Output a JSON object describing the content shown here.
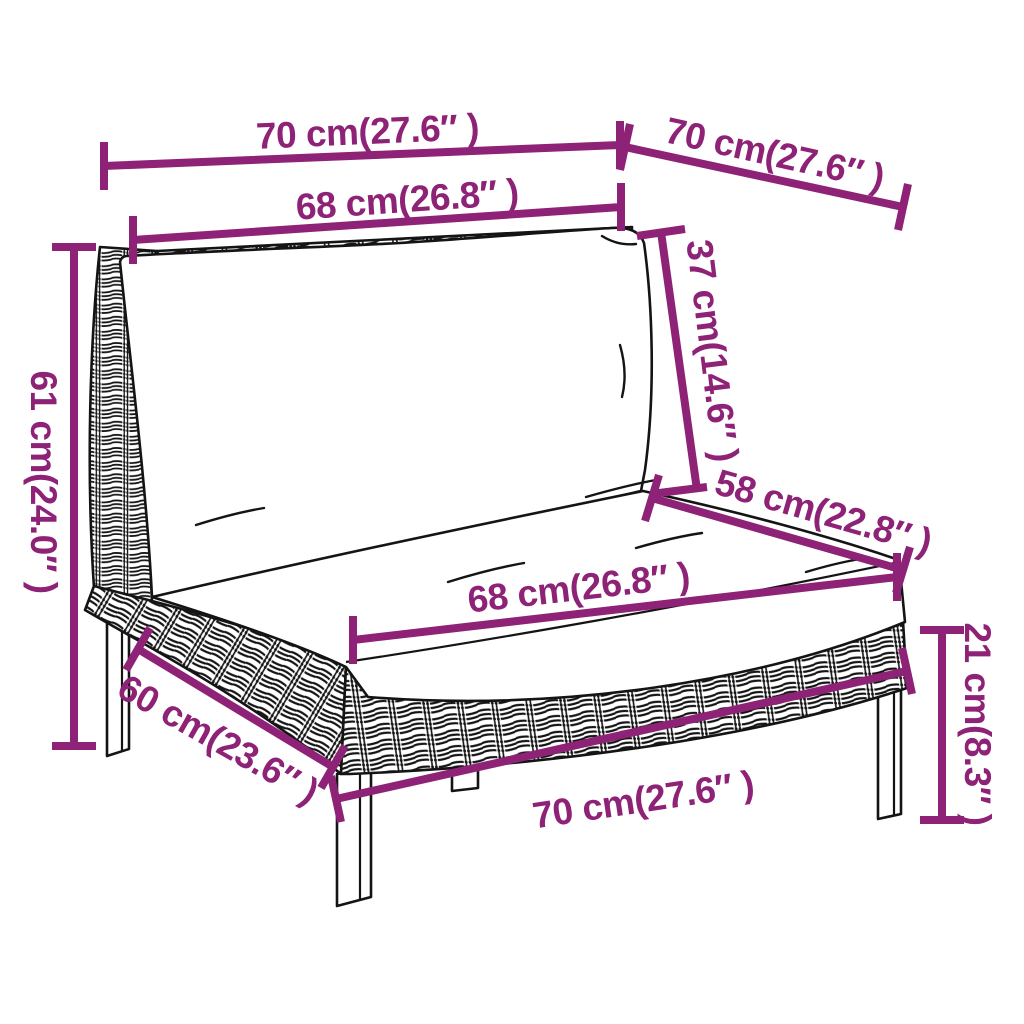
{
  "diagram": {
    "accent_color": "#8e2276",
    "outline_color": "#141414",
    "background_color": "#ffffff",
    "dimensions": {
      "top_width": "70 cm(27.6″ )",
      "top_depth": "70 cm(27.6″ )",
      "back_cushion_width": "68 cm(26.8″ )",
      "back_cushion_height": "37 cm(14.6″ )",
      "overall_height": "61 cm(24.0″ )",
      "seat_depth": "58 cm(22.8″ )",
      "seat_cushion_width": "68 cm(26.8″ )",
      "leg_height": "21 cm(8.3″ )",
      "base_side_depth": "60 cm(23.6″ )",
      "base_front_width": "70 cm(27.6″ )"
    }
  }
}
